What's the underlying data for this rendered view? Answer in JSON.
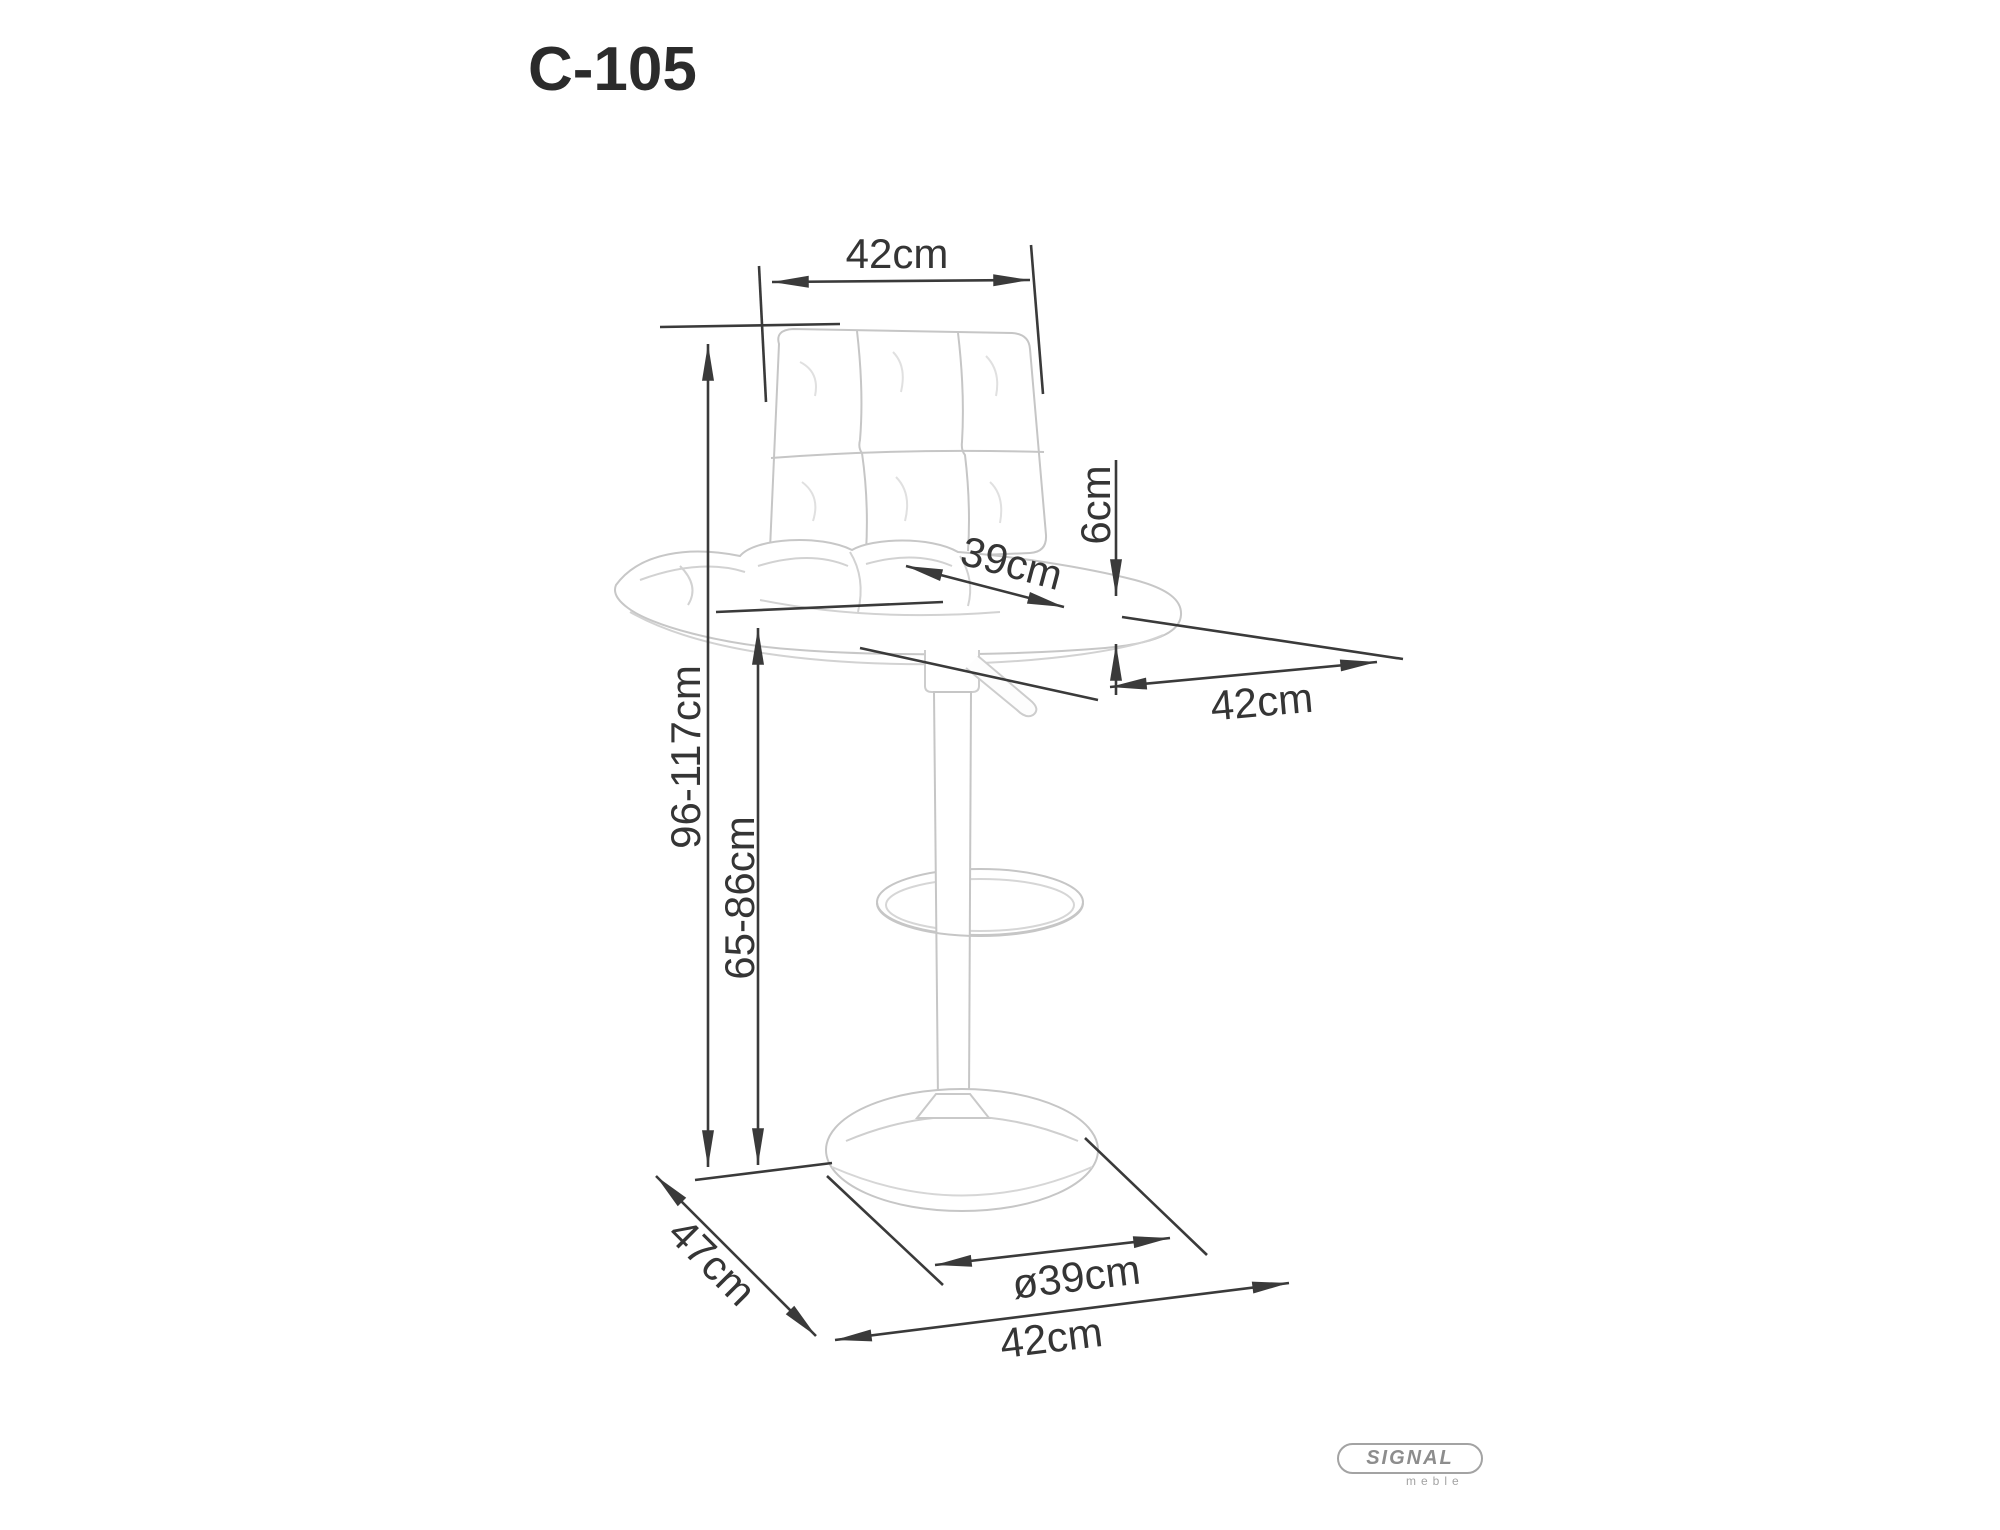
{
  "title": "C-105",
  "logo": {
    "brand": "SIGNAL",
    "subtitle": "meble"
  },
  "dimensions": {
    "backrest_width": "42cm",
    "total_height": "96-117cm",
    "seat_height": "65-86cm",
    "seat_surface_depth": "39cm",
    "seat_thickness": "6cm",
    "seat_depth": "42cm",
    "base_diameter": "ø39cm",
    "footprint_width": "42cm",
    "footprint_depth": "47cm"
  },
  "colors": {
    "dimension_line": "#3a3a3a",
    "chair_outline": "#c6c6c6",
    "background": "#ffffff",
    "logo_gray": "#8d8d8d"
  }
}
